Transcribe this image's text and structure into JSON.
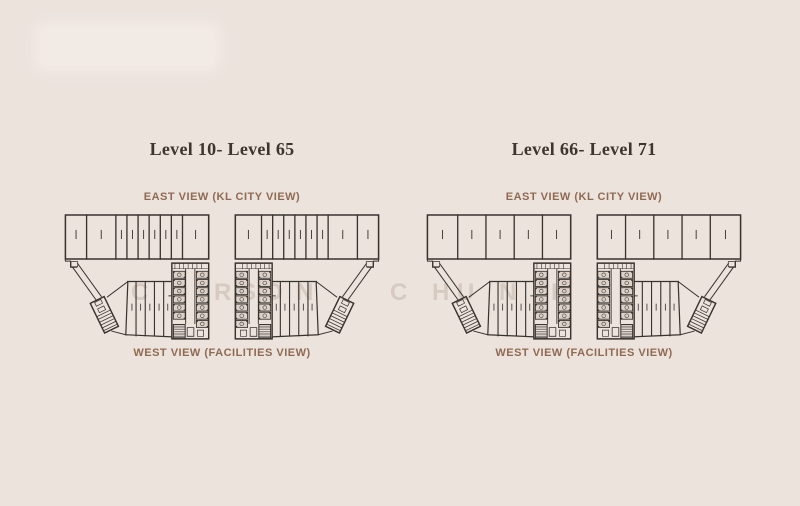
{
  "colors": {
    "background": "#ece3dd",
    "plan_line": "#39332e",
    "title_text": "#3e352e",
    "view_label_text": "#8f6a52",
    "room_fill": "#ddd2c9",
    "logo_patch": "#f2eae4",
    "watermark_text": "#b3a295"
  },
  "columns": [
    {
      "title": "Level 10- Level 65",
      "east_label": "EAST VIEW (KL CITY VIEW)",
      "west_label": "WEST VIEW (FACILITIES VIEW)",
      "plan": {
        "type": "residential-floor-plate",
        "wings": 2,
        "mirrored": true,
        "top_unit_widths": [
          21,
          29,
          11,
          11,
          11,
          11,
          11,
          11,
          26
        ],
        "core_rooms_per_column": 6
      }
    },
    {
      "title": "Level 66- Level 71",
      "east_label": "EAST VIEW (KL CITY VIEW)",
      "west_label": "WEST VIEW (FACILITIES VIEW)",
      "plan": {
        "type": "residential-floor-plate",
        "wings": 2,
        "mirrored": true,
        "top_unit_widths": [
          30,
          28,
          28,
          28,
          28
        ],
        "core_rooms_per_column": 6
      }
    }
  ],
  "watermark": {
    "letters": [
      {
        "ch": "C",
        "x": 131
      },
      {
        "ch": "I",
        "x": 180
      },
      {
        "ch": "R",
        "x": 214
      },
      {
        "ch": "S",
        "x": 240
      },
      {
        "ch": "O",
        "x": 264
      },
      {
        "ch": "N",
        "x": 296
      },
      {
        "ch": "C",
        "x": 390
      },
      {
        "ch": "H",
        "x": 432
      },
      {
        "ch": "U",
        "x": 457
      },
      {
        "ch": "N",
        "x": 499
      },
      {
        "ch": "K",
        "x": 551
      },
      {
        "ch": "T",
        "x": 596
      }
    ]
  }
}
